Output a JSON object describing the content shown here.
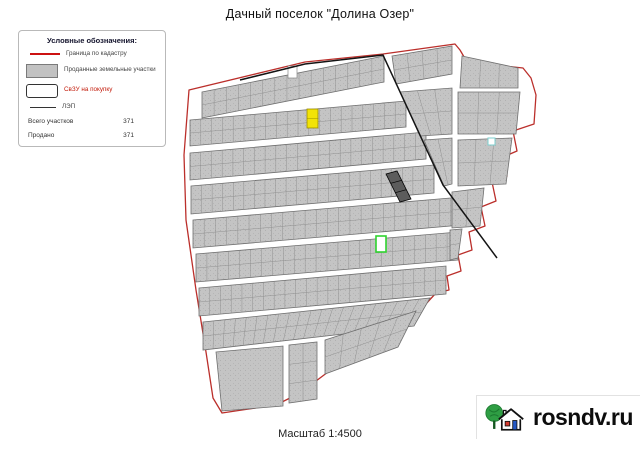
{
  "page": {
    "title": "Дачный поселок  \"Долина Озер\"",
    "scale_label": "Масштаб 1:4500"
  },
  "legend": {
    "title": "Условные обозначения:",
    "items": [
      {
        "key": "cadastre-boundary",
        "swatch": "red-line",
        "label": "Граница по кадастру"
      },
      {
        "key": "sold-parcels",
        "swatch": "gray-box",
        "label": "Проданные земельные участки"
      },
      {
        "key": "parcels-for-sale",
        "swatch": "white-box",
        "label": "СвЗУ на покупку",
        "label_color": "#c21807"
      },
      {
        "key": "power-line",
        "swatch": "dark-line",
        "label": "ЛЭП"
      }
    ],
    "totals": [
      {
        "label": "Всего участков",
        "value": "371"
      },
      {
        "label": "Продано",
        "value": "371"
      }
    ]
  },
  "watermark": {
    "text": "rosndv.ru"
  },
  "colors": {
    "boundary": "#bb2f2b",
    "parcel_fill": "#c4c4c4",
    "parcel_stroke": "#8b8b8b",
    "strip_stroke": "#6f6f6f",
    "road": "#ffffff",
    "sold_yellow": "#f2e307",
    "yellow_stroke": "#9a8c00",
    "highlight_green": "#2fd32f",
    "teal_stroke": "#7ccfcf",
    "power_line": "#141414",
    "dark_parcel": "#5c5c5c"
  },
  "map": {
    "width": 640,
    "height": 452,
    "boundary_points": "189,90 305,62 383,54 455,44 460,50 467,62 523,68 531,78 536,95 534,124 513,131 517,151 503,157 507,176 492,182 496,201 481,207 485,226 469,232 472,250 458,255 461,271 447,276 449,290 436,293 424,306 410,318 396,330 380,342 362,352 344,362 328,372 312,384 298,394 282,402 262,407 242,410 222,413 213,398 206,352 196,290 186,220 184,155",
    "power_line_points": "240,80 305,64 383,55 443,185 497,258",
    "strips": [
      {
        "name": "top-band",
        "q": [
          202,
          92,
          384,
          56,
          384,
          82,
          202,
          118
        ],
        "cols": 15,
        "rows": 2
      },
      {
        "name": "row-2",
        "q": [
          190,
          120,
          406,
          101,
          406,
          127,
          190,
          146
        ],
        "cols": 20,
        "rows": 2
      },
      {
        "name": "row-3",
        "q": [
          190,
          153,
          426,
          132,
          426,
          159,
          190,
          180
        ],
        "cols": 22,
        "rows": 2
      },
      {
        "name": "row-4",
        "q": [
          191,
          186,
          434,
          165,
          434,
          193,
          191,
          214
        ],
        "cols": 23,
        "rows": 2
      },
      {
        "name": "row-5",
        "q": [
          193,
          220,
          462,
          197,
          462,
          225,
          193,
          248
        ],
        "cols": 24,
        "rows": 2
      },
      {
        "name": "row-6",
        "q": [
          196,
          254,
          458,
          232,
          458,
          260,
          196,
          282
        ],
        "cols": 24,
        "rows": 2
      },
      {
        "name": "row-7",
        "q": [
          199,
          288,
          446,
          266,
          446,
          294,
          199,
          316
        ],
        "cols": 23,
        "rows": 2
      },
      {
        "name": "row-8",
        "q": [
          203,
          322,
          430,
          298,
          414,
          326,
          203,
          350
        ],
        "cols": 21,
        "rows": 2
      },
      {
        "name": "ne-block-1",
        "q": [
          392,
          56,
          452,
          46,
          452,
          74,
          396,
          84
        ],
        "cols": 4,
        "rows": 2
      },
      {
        "name": "ne-block-2",
        "q": [
          462,
          56,
          518,
          68,
          518,
          88,
          460,
          88
        ],
        "cols": 3,
        "rows": 1
      },
      {
        "name": "e-block-1",
        "q": [
          400,
          92,
          452,
          88,
          452,
          134,
          420,
          136
        ],
        "cols": 3,
        "rows": 2
      },
      {
        "name": "e-block-2",
        "q": [
          458,
          92,
          520,
          92,
          516,
          134,
          458,
          134
        ],
        "cols": 3,
        "rows": 2
      },
      {
        "name": "e-block-3",
        "q": [
          424,
          140,
          452,
          138,
          452,
          184,
          444,
          186
        ],
        "cols": 2,
        "rows": 2
      },
      {
        "name": "e-block-4",
        "q": [
          458,
          140,
          512,
          138,
          506,
          184,
          458,
          186
        ],
        "cols": 3,
        "rows": 2
      },
      {
        "name": "e-block-5",
        "q": [
          452,
          192,
          484,
          188,
          480,
          226,
          452,
          228
        ],
        "cols": 2,
        "rows": 2
      },
      {
        "name": "e-block-6",
        "q": [
          450,
          230,
          462,
          229,
          458,
          258,
          450,
          260
        ],
        "cols": 1,
        "rows": 2
      },
      {
        "name": "sw-large-parcel",
        "q": [
          216,
          352,
          283,
          346,
          283,
          406,
          222,
          411
        ],
        "cols": 1,
        "rows": 1
      },
      {
        "name": "s-block-1",
        "q": [
          289,
          345,
          317,
          342,
          317,
          399,
          289,
          403
        ],
        "cols": 2,
        "rows": 3
      },
      {
        "name": "s-block-2",
        "q": [
          325,
          340,
          416,
          311,
          398,
          347,
          325,
          374
        ],
        "cols": 5,
        "rows": 2
      }
    ],
    "special_parcels": [
      {
        "kind": "white",
        "name": "unsold-parcel",
        "x": 288,
        "y": 66,
        "w": 9,
        "h": 12
      },
      {
        "kind": "yellow",
        "name": "yellow-marked-parcel",
        "x": 307,
        "y": 109,
        "w": 11,
        "h": 19
      },
      {
        "kind": "dark",
        "name": "dark-hatched-parcel",
        "points": [
          386,
          174,
          397,
          171,
          411,
          199,
          400,
          202
        ]
      },
      {
        "kind": "teal",
        "name": "teal-marked-parcel",
        "x": 488,
        "y": 138,
        "w": 7,
        "h": 7
      },
      {
        "kind": "green",
        "name": "green-outlined-parcel",
        "x": 376,
        "y": 236,
        "w": 10,
        "h": 16
      }
    ]
  }
}
